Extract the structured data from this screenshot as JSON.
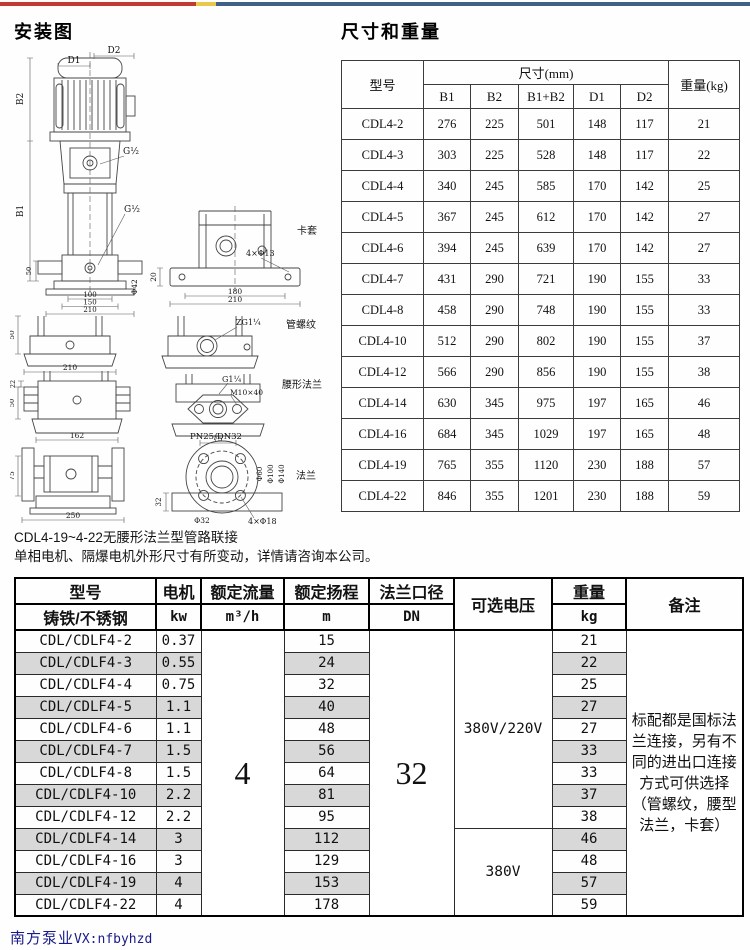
{
  "topbar": {
    "red": "#c23a32",
    "yellow": "#e9c84a",
    "blue": "#40608c"
  },
  "install": {
    "title": "安装图",
    "labels": {
      "d2": "D2",
      "d1": "D1",
      "b2": "B2",
      "b1": "B1",
      "g_top": "G½",
      "g_bottom": "G½",
      "a50": "50",
      "a100": "100",
      "a150": "150",
      "a210": "210",
      "phi42": "Φ42",
      "clamp_tag": "卡套",
      "b_holes": "4×Φ13",
      "b20": "20",
      "b180": "180",
      "b210": "210",
      "c50": "50",
      "c210": "210",
      "zg": "ZG1¼",
      "thread_tag": "管螺纹",
      "e22": "22",
      "e50": "50",
      "e162": "162",
      "g114": "G1¼",
      "m10": "M10×40",
      "f75": "75",
      "waist_tag": "腰形法兰",
      "g75": "75",
      "g250": "250",
      "pn": "PN25/DN32",
      "h32": "32",
      "h_bore": "Φ32",
      "h_holes": "4×Φ18",
      "phi60": "Φ60",
      "phi100": "Φ100",
      "phi140": "Φ140",
      "flange_tag": "法兰"
    }
  },
  "notes": [
    "CDL4-19~4-22无腰形法兰型管路联接",
    "单相电机、隔爆电机外形尺寸有所变动，详情请咨询本公司。"
  ],
  "dim_table": {
    "title": "尺寸和重量",
    "col_model": "型号",
    "col_size": "尺寸(mm)",
    "col_weight": "重量(kg)",
    "sub_cols": [
      "B1",
      "B2",
      "B1+B2",
      "D1",
      "D2"
    ],
    "rows": [
      [
        "CDL4-2",
        "276",
        "225",
        "501",
        "148",
        "117",
        "21"
      ],
      [
        "CDL4-3",
        "303",
        "225",
        "528",
        "148",
        "117",
        "22"
      ],
      [
        "CDL4-4",
        "340",
        "245",
        "585",
        "170",
        "142",
        "25"
      ],
      [
        "CDL4-5",
        "367",
        "245",
        "612",
        "170",
        "142",
        "27"
      ],
      [
        "CDL4-6",
        "394",
        "245",
        "639",
        "170",
        "142",
        "27"
      ],
      [
        "CDL4-7",
        "431",
        "290",
        "721",
        "190",
        "155",
        "33"
      ],
      [
        "CDL4-8",
        "458",
        "290",
        "748",
        "190",
        "155",
        "33"
      ],
      [
        "CDL4-10",
        "512",
        "290",
        "802",
        "190",
        "155",
        "37"
      ],
      [
        "CDL4-12",
        "566",
        "290",
        "856",
        "190",
        "155",
        "38"
      ],
      [
        "CDL4-14",
        "630",
        "345",
        "975",
        "197",
        "165",
        "46"
      ],
      [
        "CDL4-16",
        "684",
        "345",
        "1029",
        "197",
        "165",
        "48"
      ],
      [
        "CDL4-19",
        "765",
        "355",
        "1120",
        "230",
        "188",
        "57"
      ],
      [
        "CDL4-22",
        "846",
        "355",
        "1201",
        "230",
        "188",
        "59"
      ]
    ]
  },
  "spec_table": {
    "header": {
      "model": "型号",
      "model_sub": "铸铁/不锈钢",
      "motor": "电机",
      "motor_unit": "kw",
      "flow": "额定流量",
      "flow_unit": "m³/h",
      "head": "额定扬程",
      "head_unit": "m",
      "flange": "法兰口径",
      "flange_unit": "DN",
      "voltage": "可选电压",
      "weight": "重量",
      "weight_unit": "kg",
      "remark": "备注"
    },
    "flow_value": "4",
    "flange_value": "32",
    "voltage_groups": [
      {
        "label": "380V/220V",
        "rows": 9
      },
      {
        "label": "380V",
        "rows": 4
      }
    ],
    "remark_text": "标配都是国标法兰连接，另有不同的进出口连接方式可供选择（管螺纹，腰型法兰，卡套）",
    "rows": [
      {
        "model": "CDL/CDLF4-2",
        "kw": "0.37",
        "head": "15",
        "weight": "21"
      },
      {
        "model": "CDL/CDLF4-3",
        "kw": "0.55",
        "head": "24",
        "weight": "22"
      },
      {
        "model": "CDL/CDLF4-4",
        "kw": "0.75",
        "head": "32",
        "weight": "25"
      },
      {
        "model": "CDL/CDLF4-5",
        "kw": "1.1",
        "head": "40",
        "weight": "27"
      },
      {
        "model": "CDL/CDLF4-6",
        "kw": "1.1",
        "head": "48",
        "weight": "27"
      },
      {
        "model": "CDL/CDLF4-7",
        "kw": "1.5",
        "head": "56",
        "weight": "33"
      },
      {
        "model": "CDL/CDLF4-8",
        "kw": "1.5",
        "head": "64",
        "weight": "33"
      },
      {
        "model": "CDL/CDLF4-10",
        "kw": "2.2",
        "head": "81",
        "weight": "37"
      },
      {
        "model": "CDL/CDLF4-12",
        "kw": "2.2",
        "head": "95",
        "weight": "38"
      },
      {
        "model": "CDL/CDLF4-14",
        "kw": "3",
        "head": "112",
        "weight": "46"
      },
      {
        "model": "CDL/CDLF4-16",
        "kw": "3",
        "head": "129",
        "weight": "48"
      },
      {
        "model": "CDL/CDLF4-19",
        "kw": "4",
        "head": "153",
        "weight": "57"
      },
      {
        "model": "CDL/CDLF4-22",
        "kw": "4",
        "head": "178",
        "weight": "59"
      }
    ]
  },
  "footer": {
    "brand": "南方泵业",
    "wechat": "VX:nfbyhzd"
  }
}
